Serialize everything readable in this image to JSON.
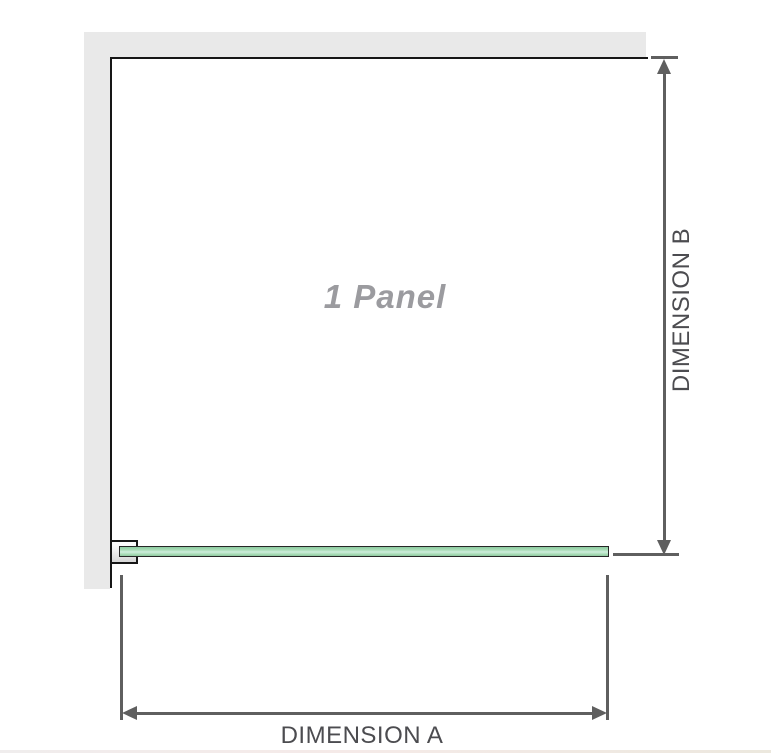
{
  "diagram": {
    "panel": {
      "label": "1 Panel"
    },
    "dimension_a": {
      "label": "DIMENSION A",
      "orientation": "horizontal"
    },
    "dimension_b": {
      "label": "DIMENSION B",
      "orientation": "vertical"
    }
  },
  "colors": {
    "wall": "#e9e9e9",
    "outline": "#161616",
    "dimension": "#5f5f5f",
    "label_text": "#4c4c50",
    "panel_text": "#9b9b9f",
    "glass_fill": "#a8dcb6",
    "glass_highlight": "#cfeedd",
    "glass_border": "#262626"
  }
}
